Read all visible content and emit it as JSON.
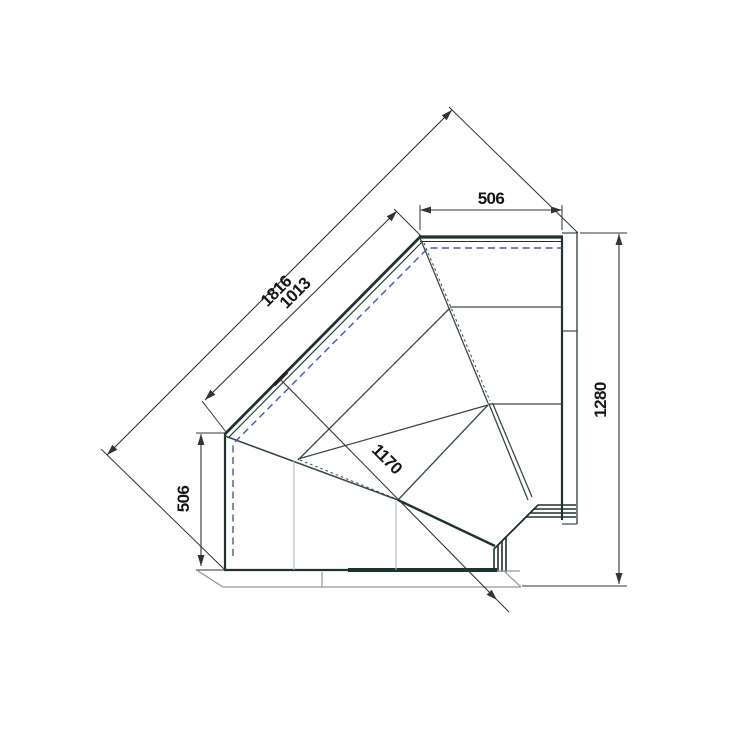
{
  "drawing": {
    "type": "technical-plan-view",
    "subject": "90-degree internal corner display counter, top plan view with dimensions",
    "dimensions": [
      {
        "name": "top-end-width",
        "label": "506"
      },
      {
        "name": "overall-front-width",
        "label": "1816"
      },
      {
        "name": "glass-front-width",
        "label": "1013"
      },
      {
        "name": "left-end-width",
        "label": "506"
      },
      {
        "name": "overall-right-depth",
        "label": "1280"
      },
      {
        "name": "serve-over-depth",
        "label": "1170"
      }
    ],
    "colors": {
      "line_dark": "#1e3231",
      "line_medium": "#3a4a48",
      "line_light": "#b0bcbc",
      "line_plinth": "#8a9898",
      "dimension": "#343434",
      "hidden_dashed_blue": "#4a55a8",
      "text": "#161616",
      "background": "#ffffff"
    }
  }
}
